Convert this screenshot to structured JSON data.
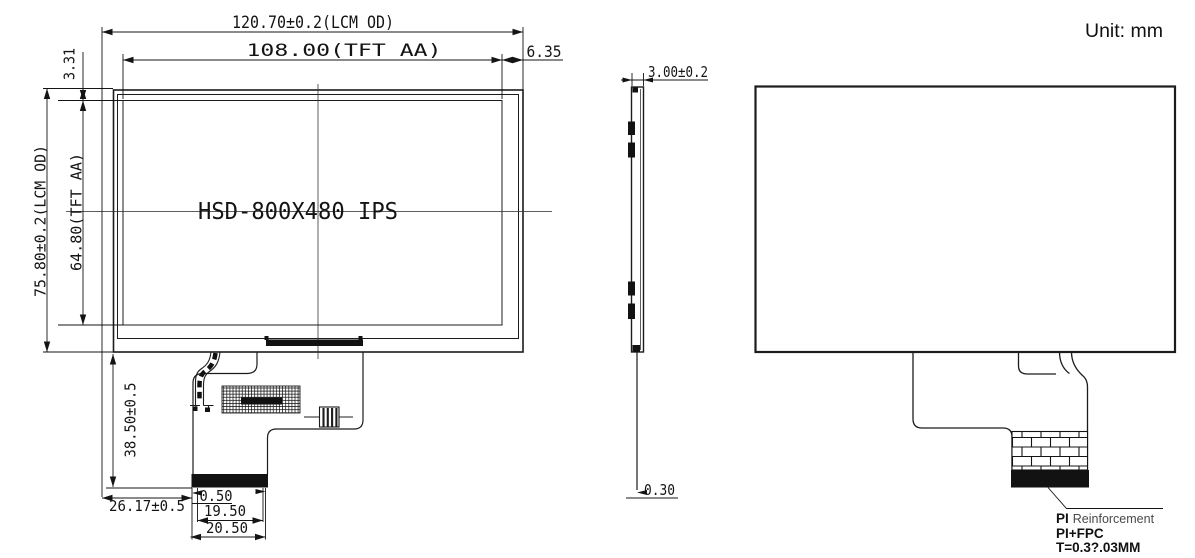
{
  "unit": {
    "label": "Unit: mm"
  },
  "front_view": {
    "model_label": "HSD-800X480 IPS",
    "dimensions": {
      "lcm_outline_width": "120.70±0.2(LCM OD)",
      "active_area_width": "108.00(TFT AA)",
      "right_edge_to_aa": "6.35",
      "top_edge_to_aa": "3.31",
      "lcm_outline_height": "75.80±0.2(LCM OD)",
      "active_area_height": "64.80(TFT AA)",
      "fpc_length": "38.50±0.5",
      "fpc_left_offset": "26.17±0.5",
      "contact_margin": "0.50",
      "contact_area_width": "19.50",
      "fpc_end_width": "20.50"
    }
  },
  "side_view": {
    "dimensions": {
      "module_thickness": "3.00±0.2",
      "fpc_thickness": "0.30"
    }
  },
  "back_view": {
    "fpc_note": {
      "line1_bold": "PI",
      "line1_rest": "Reinforcement",
      "line2": "PI+FPC",
      "line3": "T=0.3?.03MM"
    }
  }
}
